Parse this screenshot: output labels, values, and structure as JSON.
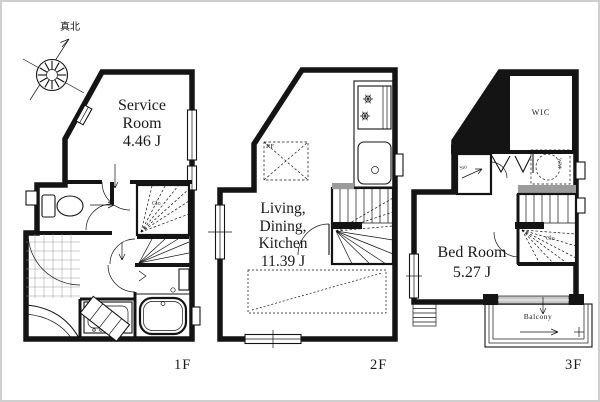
{
  "compass": {
    "north_label": "真北"
  },
  "floors": {
    "f1": {
      "label": "1F",
      "room_line1": "Service",
      "room_line2": "Room",
      "room_area": "4.46 J",
      "closet": "Clo"
    },
    "f2": {
      "label": "2F",
      "room_line1": "Living,",
      "room_line2": "Dining,",
      "room_line3": "Kitchen",
      "room_area": "11.39 J",
      "fridge": "RF"
    },
    "f3": {
      "label": "3F",
      "room_line1": "Bed Room",
      "room_area": "5.27 J",
      "wic": "WIC",
      "storage": "Sto",
      "washer": "WM",
      "closet": "Clo",
      "balcony": "Balcony"
    }
  },
  "colors": {
    "wall": "#141414",
    "counter_gray": "#9b9b9b",
    "frame": "#cfcfcf"
  }
}
